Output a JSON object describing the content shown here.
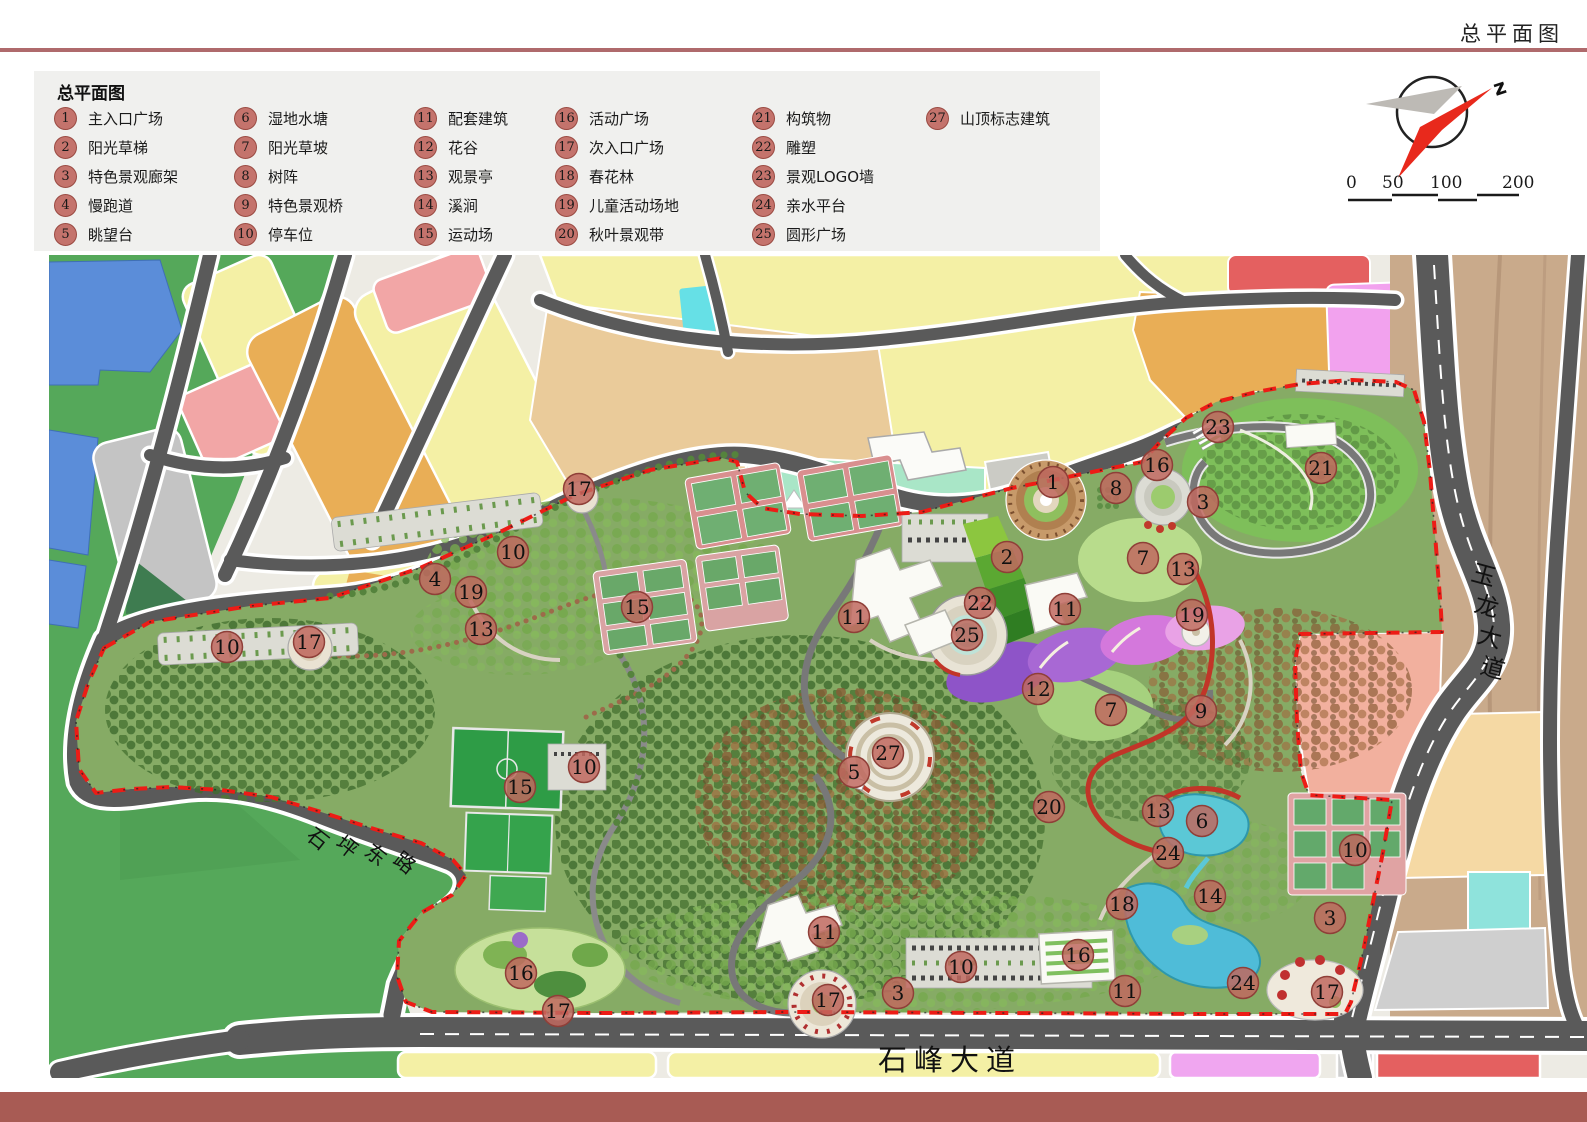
{
  "page": {
    "title": "总平面图"
  },
  "legend": {
    "title": "总平面图",
    "columns": [
      [
        {
          "n": "1",
          "label": "主入口广场"
        },
        {
          "n": "2",
          "label": "阳光草梯"
        },
        {
          "n": "3",
          "label": "特色景观廊架"
        },
        {
          "n": "4",
          "label": "慢跑道"
        },
        {
          "n": "5",
          "label": "眺望台"
        }
      ],
      [
        {
          "n": "6",
          "label": "湿地水塘"
        },
        {
          "n": "7",
          "label": "阳光草坡"
        },
        {
          "n": "8",
          "label": "树阵"
        },
        {
          "n": "9",
          "label": "特色景观桥"
        },
        {
          "n": "10",
          "label": "停车位"
        }
      ],
      [
        {
          "n": "11",
          "label": "配套建筑"
        },
        {
          "n": "12",
          "label": "花谷"
        },
        {
          "n": "13",
          "label": "观景亭"
        },
        {
          "n": "14",
          "label": "溪涧"
        },
        {
          "n": "15",
          "label": "运动场"
        }
      ],
      [
        {
          "n": "16",
          "label": "活动广场"
        },
        {
          "n": "17",
          "label": "次入口广场"
        },
        {
          "n": "18",
          "label": "春花林"
        },
        {
          "n": "19",
          "label": "儿童活动场地"
        },
        {
          "n": "20",
          "label": "秋叶景观带"
        }
      ],
      [
        {
          "n": "21",
          "label": "构筑物"
        },
        {
          "n": "22",
          "label": "雕塑"
        },
        {
          "n": "23",
          "label": "景观LOGO墙"
        },
        {
          "n": "24",
          "label": "亲水平台"
        },
        {
          "n": "25",
          "label": "圆形广场"
        }
      ],
      [
        {
          "n": "27",
          "label": "山顶标志建筑"
        }
      ]
    ]
  },
  "compass": {
    "north_label": "z"
  },
  "scale_bar": {
    "ticks": [
      {
        "label": "0",
        "x": 1346
      },
      {
        "label": "50",
        "x": 1382
      },
      {
        "label": "100",
        "x": 1430
      },
      {
        "label": "200",
        "x": 1502
      }
    ]
  },
  "map": {
    "road_labels": [
      {
        "text": "石坪东路",
        "x": 305,
        "y": 838,
        "dx": 29,
        "dy": 8,
        "rotate": 38,
        "size": 21
      },
      {
        "text": "石峰大道",
        "x": 878,
        "y": 1070,
        "dx": 36,
        "dy": 0,
        "rotate": 0,
        "size": 29
      },
      {
        "text": "玉龙大道",
        "x": 1470,
        "y": 580,
        "dx": 3,
        "dy": 31,
        "rotate": 15,
        "size": 24
      }
    ],
    "markers": [
      {
        "n": "17",
        "x": 579,
        "y": 489
      },
      {
        "n": "10",
        "x": 513,
        "y": 552
      },
      {
        "n": "4",
        "x": 435,
        "y": 579
      },
      {
        "n": "19",
        "x": 471,
        "y": 592
      },
      {
        "n": "13",
        "x": 481,
        "y": 629
      },
      {
        "n": "10",
        "x": 227,
        "y": 647
      },
      {
        "n": "17",
        "x": 309,
        "y": 642
      },
      {
        "n": "15",
        "x": 637,
        "y": 607
      },
      {
        "n": "11",
        "x": 854,
        "y": 617
      },
      {
        "n": "22",
        "x": 980,
        "y": 603
      },
      {
        "n": "25",
        "x": 967,
        "y": 635
      },
      {
        "n": "2",
        "x": 1007,
        "y": 557
      },
      {
        "n": "1",
        "x": 1053,
        "y": 482
      },
      {
        "n": "8",
        "x": 1116,
        "y": 488
      },
      {
        "n": "16",
        "x": 1157,
        "y": 465
      },
      {
        "n": "3",
        "x": 1203,
        "y": 502
      },
      {
        "n": "23",
        "x": 1218,
        "y": 427
      },
      {
        "n": "21",
        "x": 1321,
        "y": 468
      },
      {
        "n": "7",
        "x": 1143,
        "y": 558
      },
      {
        "n": "13",
        "x": 1183,
        "y": 569
      },
      {
        "n": "11",
        "x": 1065,
        "y": 609
      },
      {
        "n": "19",
        "x": 1192,
        "y": 615
      },
      {
        "n": "12",
        "x": 1038,
        "y": 689
      },
      {
        "n": "7",
        "x": 1111,
        "y": 710
      },
      {
        "n": "9",
        "x": 1201,
        "y": 711
      },
      {
        "n": "27",
        "x": 888,
        "y": 753
      },
      {
        "n": "5",
        "x": 854,
        "y": 772
      },
      {
        "n": "10",
        "x": 584,
        "y": 767
      },
      {
        "n": "15",
        "x": 520,
        "y": 787
      },
      {
        "n": "20",
        "x": 1049,
        "y": 807
      },
      {
        "n": "13",
        "x": 1158,
        "y": 811
      },
      {
        "n": "6",
        "x": 1202,
        "y": 821
      },
      {
        "n": "24",
        "x": 1168,
        "y": 853
      },
      {
        "n": "10",
        "x": 1355,
        "y": 850
      },
      {
        "n": "14",
        "x": 1210,
        "y": 896
      },
      {
        "n": "18",
        "x": 1122,
        "y": 904
      },
      {
        "n": "3",
        "x": 1330,
        "y": 918
      },
      {
        "n": "11",
        "x": 824,
        "y": 932
      },
      {
        "n": "16",
        "x": 521,
        "y": 973
      },
      {
        "n": "17",
        "x": 558,
        "y": 1011
      },
      {
        "n": "17",
        "x": 828,
        "y": 1000
      },
      {
        "n": "3",
        "x": 898,
        "y": 993
      },
      {
        "n": "10",
        "x": 961,
        "y": 967
      },
      {
        "n": "16",
        "x": 1078,
        "y": 955
      },
      {
        "n": "11",
        "x": 1125,
        "y": 991
      },
      {
        "n": "24",
        "x": 1243,
        "y": 983
      },
      {
        "n": "17",
        "x": 1327,
        "y": 992
      }
    ],
    "colors": {
      "boundary_red": "#ED1C16",
      "marker_fill": "#C0685F",
      "marker_stroke": "#8F3F38",
      "road": "#5A5A5A",
      "park_green": "#86AB65",
      "field_green": "#55A85A",
      "water_blue": "#5B8DD9",
      "lake_teal": "#55C8D6",
      "parcel_yellow": "#F4F0A5",
      "parcel_orange": "#E9AE56",
      "parcel_pink": "#F2A6A6",
      "parcel_gray": "#C4C4C4",
      "parcel_tan": "#EACB9A",
      "east_tan": "#C9AA8B",
      "parcel_violet": "#F2A2EE",
      "parcel_red": "#E46060",
      "parcel_salmon": "#F2B09E",
      "parcel_mint": "#A9E6C7",
      "header_rule": "#AF6A6C",
      "footer_band": "#A85B54"
    }
  }
}
